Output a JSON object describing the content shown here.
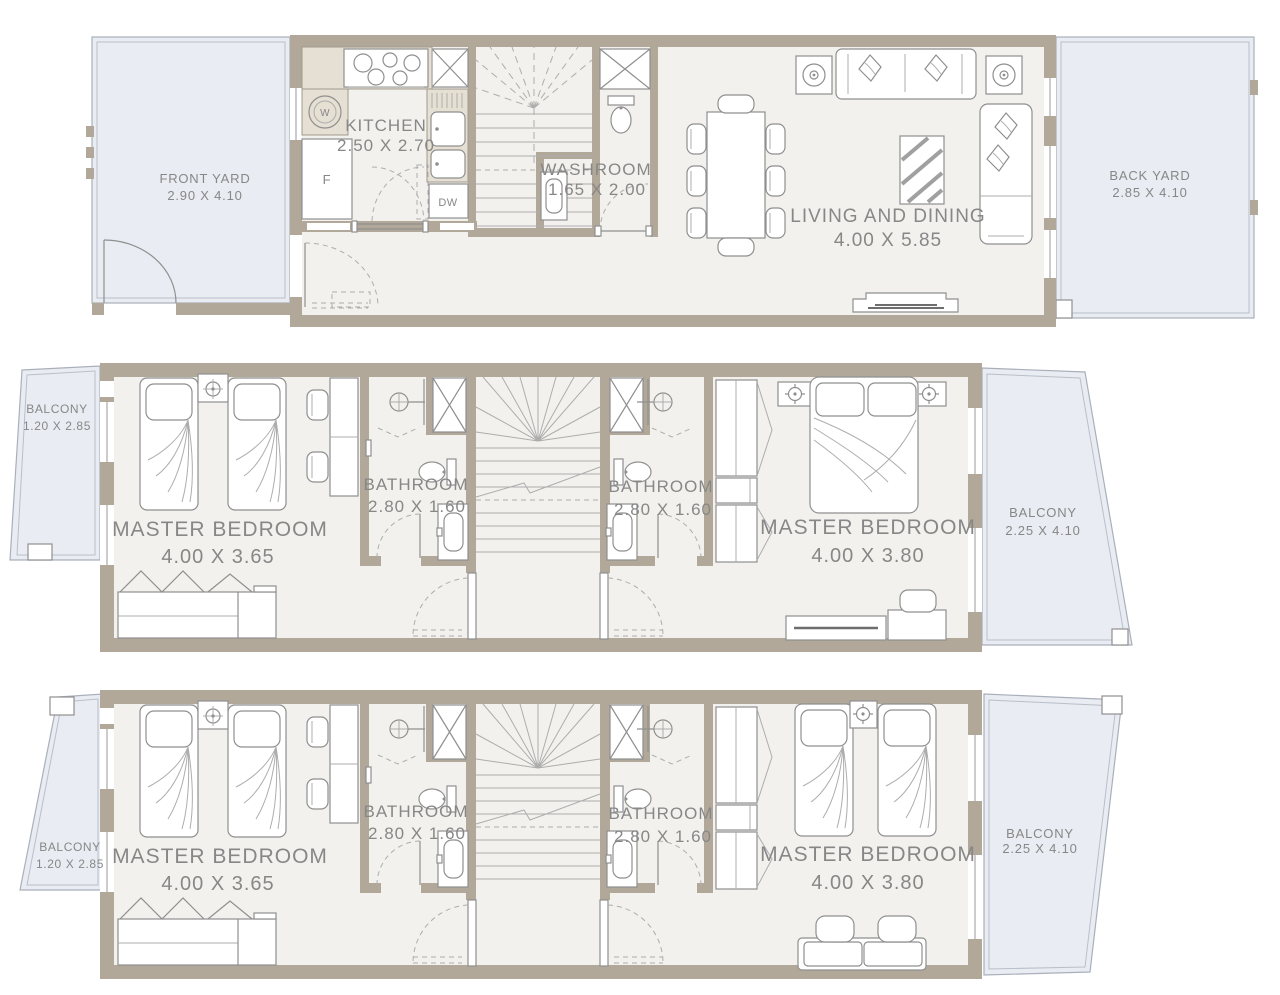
{
  "title": "Townhouse Floor Plan - 3 Levels",
  "colors": {
    "wall": "#b1a89a",
    "interior_floor": "#f2f1ee",
    "yard": "#e9ecf2",
    "counter": "#e6dfd3",
    "line": "#8f8f8f",
    "text": "#878787"
  },
  "ground": {
    "front_yard": {
      "name": "FRONT YARD",
      "dims": "2.90 X 4.10"
    },
    "kitchen": {
      "name": "KITCHEN",
      "dims": "2.50 X 2.70"
    },
    "washroom": {
      "name": "WASHROOM",
      "dims": "1.65 X 2.00"
    },
    "living_dining": {
      "name": "LIVING AND DINING",
      "dims": "4.00 X 5.85"
    },
    "back_yard": {
      "name": "BACK YARD",
      "dims": "2.85 X 4.10"
    },
    "appliances": {
      "washer": "W",
      "fridge": "F",
      "dishwasher": "DW"
    }
  },
  "floor2": {
    "balcony_left": {
      "name": "BALCONY",
      "dims": "1.20 X 2.85"
    },
    "bedroom_left": {
      "name": "MASTER BEDROOM",
      "dims": "4.00 X 3.65"
    },
    "bathroom_left": {
      "name": "BATHROOM",
      "dims": "2.80 X 1.60"
    },
    "bathroom_right": {
      "name": "BATHROOM",
      "dims": "2.80 X 1.60"
    },
    "bedroom_right": {
      "name": "MASTER BEDROOM",
      "dims": "4.00 X 3.80"
    },
    "balcony_right": {
      "name": "BALCONY",
      "dims": "2.25 X 4.10"
    }
  },
  "floor3": {
    "balcony_left": {
      "name": "BALCONY",
      "dims": "1.20 X 2.85"
    },
    "bedroom_left": {
      "name": "MASTER BEDROOM",
      "dims": "4.00 X 3.65"
    },
    "bathroom_left": {
      "name": "BATHROOM",
      "dims": "2.80 X 1.60"
    },
    "bathroom_right": {
      "name": "BATHROOM",
      "dims": "2.80 X 1.60"
    },
    "bedroom_right": {
      "name": "MASTER BEDROOM",
      "dims": "4.00 X 3.80"
    },
    "balcony_right": {
      "name": "BALCONY",
      "dims": "2.25 X 4.10"
    }
  }
}
